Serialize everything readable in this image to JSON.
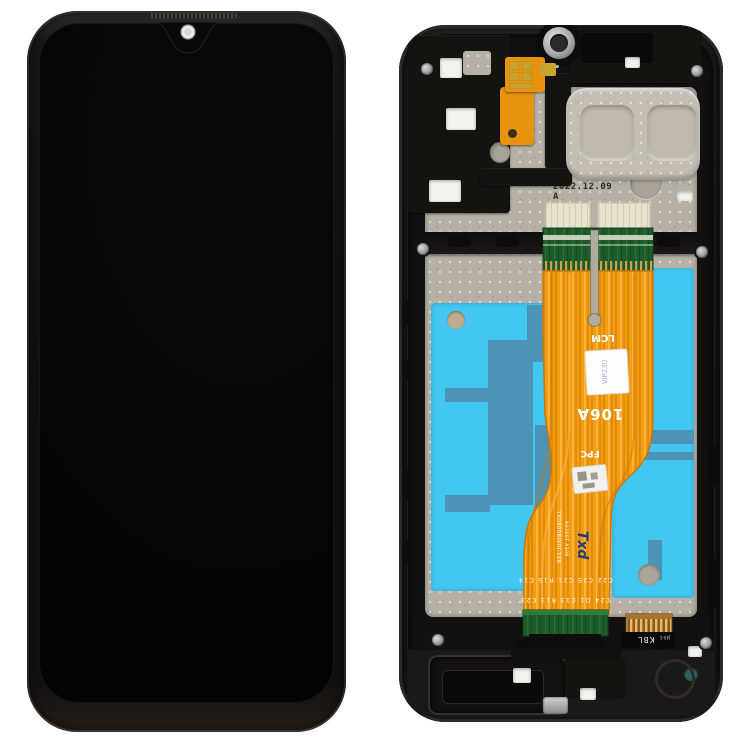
{
  "scene": {
    "description": "Product photo of a phone repair part: front LCD touch screen assembly (left) and rear mid-frame with LCD flex cable, adhesive and connectors (right)",
    "background_color": "#ffffff"
  },
  "front_assembly": {
    "body_color": "#141414",
    "screen_color": "#060606",
    "camera_dot_color": "#f0efec",
    "notch_style": "waterdrop"
  },
  "rear_frame": {
    "frame_color": "#171513",
    "plate_color": "#b6b0a5",
    "date_stamp": "2022.12.09 A",
    "etched_line1": "M02BWLTEX",
    "etched_line2": "5 Q 8",
    "adhesive_color": "#41c7f0",
    "adhesive_pattern_color": "#4d93b5"
  },
  "flex_cable": {
    "ribbon_color": "#f29d13",
    "pcb_color": "#1e5b2b",
    "label_lcm": "LCM",
    "model_label": "106A",
    "label_fpc": "FPC",
    "brand_logo": "Txd",
    "brand_color": "#233b7a",
    "part_number_line1": "TXD600B(V0)-168",
    "part_number_line2": "A0360T A106",
    "sticker_text": "VIP230",
    "component_refs_row1": "C22 C25 C21 R15 C14",
    "component_refs_row2": "C24 D1 C13 R13 C23",
    "connector_label": "KBL",
    "connector_sub_label": "J40-1",
    "connector_gold_color": "#c9942e"
  }
}
